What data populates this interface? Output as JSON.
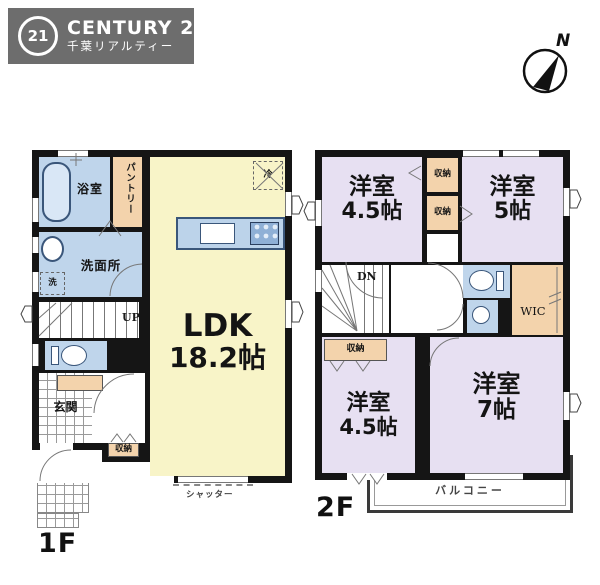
{
  "logo": {
    "mark": "21",
    "brand": "CENTURY 21",
    "subtitle": "千葉リアルティー",
    "bg_color": "#6d6d6d"
  },
  "compass": {
    "north": "N"
  },
  "f1": {
    "label": "1F",
    "bath": "浴室",
    "pantry": "パントリー",
    "washroom": "洗面所",
    "washer": "洗",
    "fridge": "冷",
    "ldk_name": "LDK",
    "ldk_size": "18.2帖",
    "up": "UP",
    "entrance": "玄関",
    "storage": "収納",
    "shutter": "シャッター"
  },
  "f2": {
    "label": "2F",
    "nw_name": "洋室",
    "nw_size": "4.5帖",
    "closet_a": "収納",
    "closet_b": "収納",
    "ne_name": "洋室",
    "ne_size": "5帖",
    "dn": "DN",
    "wic": "WIC",
    "closet_c": "収納",
    "sw_name": "洋室",
    "sw_size": "4.5帖",
    "se_name": "洋室",
    "se_size": "7帖",
    "balcony": "バルコニー"
  },
  "colors": {
    "wall": "#151515",
    "ldk_yellow": "#f8f4c8",
    "wet_blue": "#bfd5eb",
    "closet_peach": "#f3d3ac",
    "bedroom_lavender": "#e7e0f2",
    "logo_gray": "#6d6d6d"
  }
}
